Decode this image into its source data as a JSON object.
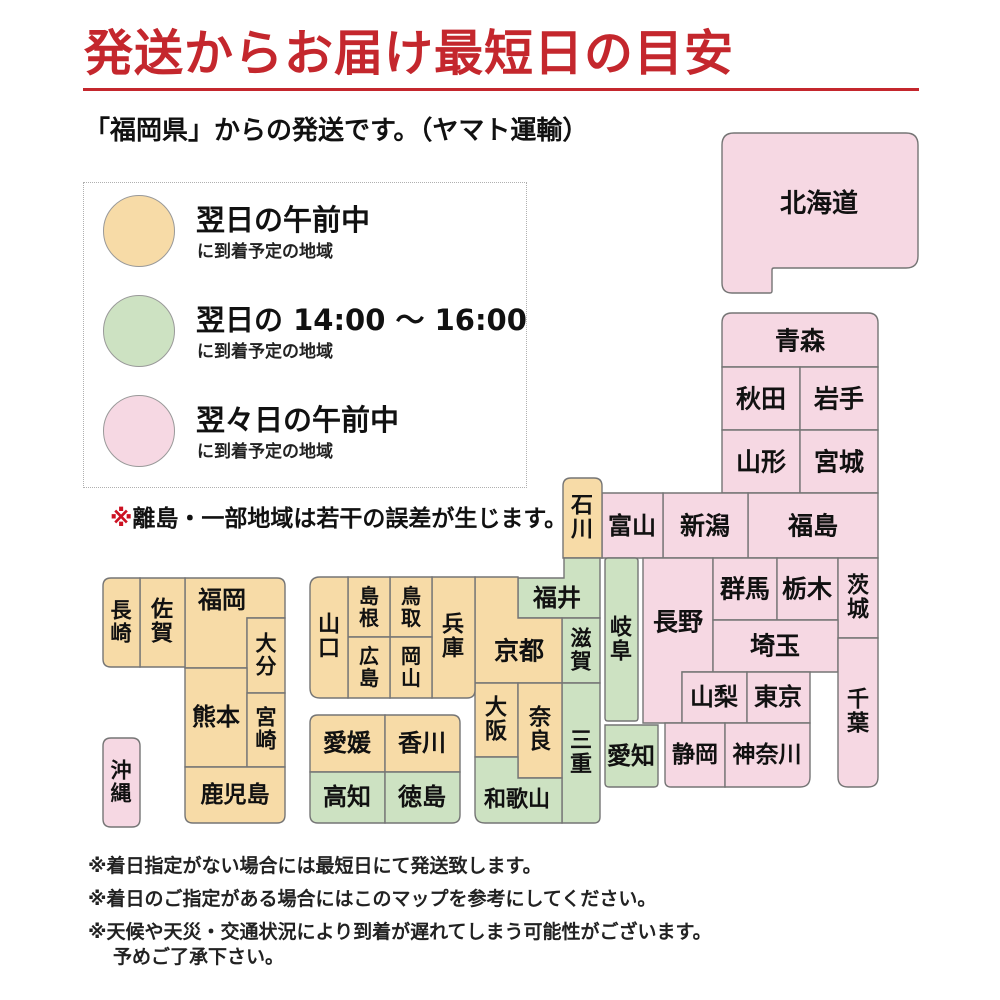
{
  "title": "発送からお届け最短日の目安",
  "subtitle": "「福岡県」からの発送です。（ヤマト運輸）",
  "colors": {
    "accent_red": "#c4272d",
    "border": "#757575",
    "zones": {
      "next_morning": "#f7dba7",
      "next_afternoon": "#cde2c2",
      "two_days": "#f6d8e3"
    }
  },
  "legend": {
    "items": [
      {
        "zone": "next_morning",
        "title": "翌日の午前中",
        "subtitle": "に到着予定の地域"
      },
      {
        "zone": "next_afternoon",
        "title": "翌日の 14:00 ～ 16:00",
        "subtitle": "に到着予定の地域"
      },
      {
        "zone": "two_days",
        "title": "翌々日の午前中",
        "subtitle": "に到着予定の地域"
      }
    ],
    "note_marker": "※",
    "note_text": "離島・一部地域は若干の誤差が生じます。"
  },
  "footnotes": [
    "※着日指定がない場合には最短日にて発送致します。",
    "※着日のご指定がある場合にはこのマップを参考にしてください。",
    "※天候や天災・交通状況により到着が遅れてしまう可能性がございます。",
    "予めご了承下さい。"
  ],
  "map": {
    "prefectures": [
      {
        "id": "hokkaido",
        "label": "北海道",
        "zone": "two_days",
        "poly": [
          [
            722,
            133
          ],
          [
            918,
            133
          ],
          [
            918,
            268
          ],
          [
            772,
            268
          ],
          [
            772,
            293
          ],
          [
            722,
            293
          ]
        ],
        "r": [
          12,
          12,
          12,
          2,
          2,
          10
        ],
        "text": [
          819,
          204
        ],
        "dir": "h",
        "fs": 26
      },
      {
        "id": "aomori",
        "label": "青森",
        "zone": "two_days",
        "rect": [
          722,
          313,
          156,
          54
        ],
        "r": [
          10,
          10,
          0,
          0
        ],
        "text": [
          800,
          341
        ],
        "dir": "h",
        "fs": 25
      },
      {
        "id": "akita",
        "label": "秋田",
        "zone": "two_days",
        "rect": [
          722,
          367,
          78,
          63
        ],
        "text": [
          761,
          399
        ],
        "dir": "h",
        "fs": 25
      },
      {
        "id": "iwate",
        "label": "岩手",
        "zone": "two_days",
        "rect": [
          800,
          367,
          78,
          63
        ],
        "text": [
          839,
          399
        ],
        "dir": "h",
        "fs": 25
      },
      {
        "id": "yamagata",
        "label": "山形",
        "zone": "two_days",
        "rect": [
          722,
          430,
          78,
          63
        ],
        "text": [
          761,
          462
        ],
        "dir": "h",
        "fs": 25
      },
      {
        "id": "miyagi",
        "label": "宮城",
        "zone": "two_days",
        "rect": [
          800,
          430,
          78,
          63
        ],
        "text": [
          839,
          462
        ],
        "dir": "h",
        "fs": 25
      },
      {
        "id": "fukushima",
        "label": "福島",
        "zone": "two_days",
        "rect": [
          748,
          493,
          130,
          65
        ],
        "text": [
          813,
          526
        ],
        "dir": "h",
        "fs": 25
      },
      {
        "id": "niigata",
        "label": "新潟",
        "zone": "two_days",
        "rect": [
          663,
          493,
          85,
          65
        ],
        "text": [
          705,
          526
        ],
        "dir": "h",
        "fs": 25
      },
      {
        "id": "toyama",
        "label": "富山",
        "zone": "two_days",
        "rect": [
          602,
          493,
          61,
          65
        ],
        "text": [
          632,
          526
        ],
        "dir": "h",
        "fs": 24
      },
      {
        "id": "ishikawa",
        "label": "石川",
        "zone": "next_morning",
        "rect": [
          563,
          478,
          39,
          80
        ],
        "r": [
          8,
          8,
          0,
          0
        ],
        "text": [
          582,
          518
        ],
        "dir": "v",
        "fs": 22
      },
      {
        "id": "nagano",
        "label": "長野",
        "zone": "two_days",
        "poly": [
          [
            643,
            558
          ],
          [
            713,
            558
          ],
          [
            713,
            672
          ],
          [
            682,
            672
          ],
          [
            682,
            723
          ],
          [
            643,
            723
          ]
        ],
        "text": [
          678,
          622
        ],
        "dir": "h",
        "fs": 25
      },
      {
        "id": "gunma",
        "label": "群馬",
        "zone": "two_days",
        "rect": [
          713,
          558,
          64,
          62
        ],
        "text": [
          745,
          589
        ],
        "dir": "h",
        "fs": 25
      },
      {
        "id": "tochigi",
        "label": "栃木",
        "zone": "two_days",
        "rect": [
          777,
          558,
          61,
          62
        ],
        "text": [
          807,
          589
        ],
        "dir": "h",
        "fs": 25
      },
      {
        "id": "ibaraki",
        "label": "茨城",
        "zone": "two_days",
        "rect": [
          838,
          558,
          40,
          80
        ],
        "text": [
          858,
          598
        ],
        "dir": "v",
        "fs": 22
      },
      {
        "id": "saitama",
        "label": "埼玉",
        "zone": "two_days",
        "rect": [
          713,
          620,
          125,
          52
        ],
        "text": [
          775,
          646
        ],
        "dir": "h",
        "fs": 25
      },
      {
        "id": "yamanashi",
        "label": "山梨",
        "zone": "two_days",
        "rect": [
          682,
          672,
          65,
          51
        ],
        "text": [
          714,
          697
        ],
        "dir": "h",
        "fs": 24
      },
      {
        "id": "tokyo",
        "label": "東京",
        "zone": "two_days",
        "rect": [
          747,
          672,
          63,
          51
        ],
        "text": [
          778,
          697
        ],
        "dir": "h",
        "fs": 24
      },
      {
        "id": "chiba",
        "label": "千葉",
        "zone": "two_days",
        "rect": [
          838,
          638,
          40,
          149
        ],
        "r": [
          0,
          0,
          10,
          10
        ],
        "text": [
          858,
          712
        ],
        "dir": "v",
        "fs": 22
      },
      {
        "id": "shizuoka",
        "label": "静岡",
        "zone": "two_days",
        "rect": [
          665,
          723,
          60,
          64
        ],
        "r": [
          0,
          0,
          0,
          6
        ],
        "text": [
          695,
          755
        ],
        "dir": "h",
        "fs": 23
      },
      {
        "id": "kanagawa",
        "label": "神奈川",
        "zone": "two_days",
        "rect": [
          725,
          723,
          85,
          64
        ],
        "r": [
          0,
          0,
          10,
          0
        ],
        "text": [
          767,
          755
        ],
        "dir": "h",
        "fs": 23
      },
      {
        "id": "gifu",
        "label": "岐阜",
        "zone": "next_afternoon",
        "rect": [
          605,
          558,
          33,
          163
        ],
        "r": [
          3,
          3,
          3,
          3
        ],
        "text": [
          621,
          640
        ],
        "dir": "v",
        "fs": 22
      },
      {
        "id": "aichi",
        "label": "愛知",
        "zone": "next_afternoon",
        "rect": [
          605,
          725,
          53,
          62
        ],
        "r": [
          0,
          0,
          4,
          4
        ],
        "text": [
          631,
          756
        ],
        "dir": "h",
        "fs": 24
      },
      {
        "id": "fukui",
        "label": "福井",
        "zone": "next_afternoon",
        "poly": [
          [
            518,
            578
          ],
          [
            564,
            578
          ],
          [
            564,
            558
          ],
          [
            600,
            558
          ],
          [
            600,
            618
          ],
          [
            518,
            618
          ]
        ],
        "text": [
          557,
          598
        ],
        "dir": "h",
        "fs": 24
      },
      {
        "id": "shiga",
        "label": "滋賀",
        "zone": "next_afternoon",
        "rect": [
          562,
          618,
          38,
          65
        ],
        "text": [
          581,
          650
        ],
        "dir": "v",
        "fs": 21
      },
      {
        "id": "mie",
        "label": "三重",
        "zone": "next_afternoon",
        "rect": [
          562,
          683,
          38,
          140
        ],
        "r": [
          0,
          0,
          6,
          0
        ],
        "text": [
          581,
          753
        ],
        "dir": "v",
        "fs": 22
      },
      {
        "id": "kyoto",
        "label": "京都",
        "zone": "next_morning",
        "poly": [
          [
            475,
            577
          ],
          [
            518,
            577
          ],
          [
            518,
            618
          ],
          [
            562,
            618
          ],
          [
            562,
            683
          ],
          [
            475,
            683
          ]
        ],
        "text": [
          519,
          651
        ],
        "dir": "h",
        "fs": 25
      },
      {
        "id": "osaka",
        "label": "大阪",
        "zone": "next_morning",
        "rect": [
          475,
          683,
          43,
          74
        ],
        "text": [
          496,
          720
        ],
        "dir": "v",
        "fs": 22
      },
      {
        "id": "nara",
        "label": "奈良",
        "zone": "next_morning",
        "rect": [
          518,
          683,
          44,
          95
        ],
        "text": [
          540,
          730
        ],
        "dir": "v",
        "fs": 22
      },
      {
        "id": "wakayama",
        "label": "和歌山",
        "zone": "next_afternoon",
        "poly": [
          [
            475,
            757
          ],
          [
            518,
            757
          ],
          [
            518,
            778
          ],
          [
            562,
            778
          ],
          [
            562,
            823
          ],
          [
            475,
            823
          ]
        ],
        "r": [
          0,
          0,
          0,
          0,
          0,
          10
        ],
        "text": [
          517,
          800
        ],
        "dir": "h",
        "fs": 22
      },
      {
        "id": "hyogo",
        "label": "兵庫",
        "zone": "next_morning",
        "rect": [
          432,
          577,
          43,
          121
        ],
        "r": [
          0,
          0,
          8,
          0
        ],
        "text": [
          453,
          637
        ],
        "dir": "v",
        "fs": 22
      },
      {
        "id": "tottori",
        "label": "鳥取",
        "zone": "next_morning",
        "rect": [
          390,
          577,
          42,
          60
        ],
        "text": [
          411,
          607
        ],
        "dir": "v",
        "fs": 20
      },
      {
        "id": "shimane",
        "label": "島根",
        "zone": "next_morning",
        "rect": [
          348,
          577,
          42,
          60
        ],
        "text": [
          369,
          607
        ],
        "dir": "v",
        "fs": 20
      },
      {
        "id": "okayama",
        "label": "岡山",
        "zone": "next_morning",
        "rect": [
          390,
          637,
          42,
          61
        ],
        "text": [
          411,
          667
        ],
        "dir": "v",
        "fs": 20
      },
      {
        "id": "hiroshima",
        "label": "広島",
        "zone": "next_morning",
        "rect": [
          348,
          637,
          42,
          61
        ],
        "text": [
          369,
          667
        ],
        "dir": "v",
        "fs": 20
      },
      {
        "id": "yamaguchi",
        "label": "山口",
        "zone": "next_morning",
        "rect": [
          310,
          577,
          38,
          121
        ],
        "r": [
          10,
          0,
          0,
          10
        ],
        "text": [
          329,
          637
        ],
        "dir": "v",
        "fs": 22
      },
      {
        "id": "ehime",
        "label": "愛媛",
        "zone": "next_morning",
        "rect": [
          310,
          715,
          75,
          57
        ],
        "r": [
          8,
          0,
          0,
          0
        ],
        "text": [
          347,
          743
        ],
        "dir": "h",
        "fs": 24
      },
      {
        "id": "kagawa",
        "label": "香川",
        "zone": "next_morning",
        "rect": [
          385,
          715,
          75,
          57
        ],
        "r": [
          0,
          8,
          0,
          0
        ],
        "text": [
          422,
          743
        ],
        "dir": "h",
        "fs": 24
      },
      {
        "id": "kochi",
        "label": "高知",
        "zone": "next_afternoon",
        "rect": [
          310,
          772,
          75,
          51
        ],
        "r": [
          0,
          0,
          0,
          8
        ],
        "text": [
          347,
          797
        ],
        "dir": "h",
        "fs": 24
      },
      {
        "id": "tokushima",
        "label": "徳島",
        "zone": "next_afternoon",
        "rect": [
          385,
          772,
          75,
          51
        ],
        "r": [
          0,
          0,
          8,
          0
        ],
        "text": [
          422,
          797
        ],
        "dir": "h",
        "fs": 24
      },
      {
        "id": "fukuoka",
        "label": "福岡",
        "zone": "next_morning",
        "poly": [
          [
            185,
            578
          ],
          [
            285,
            578
          ],
          [
            285,
            618
          ],
          [
            247,
            618
          ],
          [
            247,
            668
          ],
          [
            185,
            668
          ]
        ],
        "r": [
          0,
          8,
          0,
          0,
          0,
          0
        ],
        "text": [
          222,
          600
        ],
        "dir": "h",
        "fs": 24
      },
      {
        "id": "saga",
        "label": "佐賀",
        "zone": "next_morning",
        "rect": [
          140,
          578,
          45,
          89
        ],
        "text": [
          162,
          622
        ],
        "dir": "v",
        "fs": 22
      },
      {
        "id": "nagasaki",
        "label": "長崎",
        "zone": "next_morning",
        "rect": [
          103,
          578,
          37,
          89
        ],
        "r": [
          8,
          0,
          0,
          8
        ],
        "text": [
          121,
          622
        ],
        "dir": "v",
        "fs": 21
      },
      {
        "id": "oita",
        "label": "大分",
        "zone": "next_morning",
        "rect": [
          247,
          618,
          38,
          75
        ],
        "text": [
          266,
          655
        ],
        "dir": "v",
        "fs": 21
      },
      {
        "id": "kumamoto",
        "label": "熊本",
        "zone": "next_morning",
        "rect": [
          185,
          668,
          62,
          99
        ],
        "text": [
          216,
          717
        ],
        "dir": "h",
        "fs": 24
      },
      {
        "id": "miyazaki",
        "label": "宮崎",
        "zone": "next_morning",
        "rect": [
          247,
          693,
          38,
          74
        ],
        "text": [
          266,
          729
        ],
        "dir": "v",
        "fs": 21
      },
      {
        "id": "kagoshima",
        "label": "鹿児島",
        "zone": "next_morning",
        "rect": [
          185,
          767,
          100,
          56
        ],
        "r": [
          0,
          0,
          8,
          8
        ],
        "text": [
          235,
          795
        ],
        "dir": "h",
        "fs": 23
      },
      {
        "id": "okinawa",
        "label": "沖縄",
        "zone": "two_days",
        "rect": [
          103,
          738,
          37,
          89
        ],
        "r": [
          8,
          8,
          8,
          8
        ],
        "text": [
          121,
          782
        ],
        "dir": "v",
        "fs": 21
      }
    ]
  }
}
